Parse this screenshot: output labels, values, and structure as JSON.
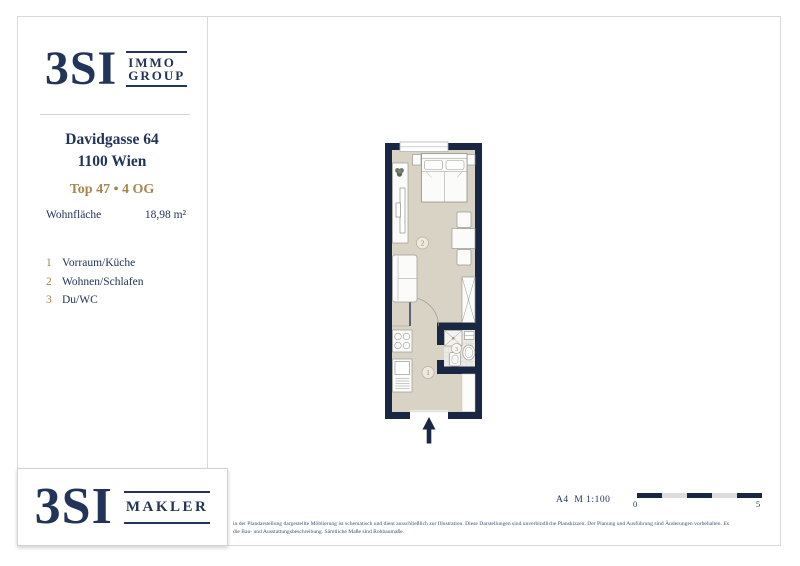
{
  "brand_top": {
    "name": "3SI",
    "line1": "IMMO",
    "line2": "GROUP"
  },
  "listing": {
    "address_line1": "Davidgasse 64",
    "address_line2": "1100 Wien",
    "unit_line": "Top 47 • 4 OG",
    "area_label": "Wohnfläche",
    "area_value": "18,98 m²"
  },
  "legend": {
    "items": [
      {
        "num": "1",
        "label": "Vorraum/Küche"
      },
      {
        "num": "2",
        "label": "Wohnen/Schlafen"
      },
      {
        "num": "3",
        "label": "Du/WC"
      }
    ]
  },
  "plan": {
    "room1_num": "1",
    "room2_num": "2",
    "room3_num": "3"
  },
  "brand_bottom": {
    "name": "3SI",
    "line1": "MAKLER"
  },
  "footer": {
    "scale_text": "A4  M 1:100",
    "scale_zero": "0",
    "scale_five": "5",
    "disclaimer_line1": "in der Plandarstellung dargestellte Möblierung ist schematisch und dient ausschließlich zur Illustration. Diese Darstellungen sind unverbindliche Planskizzen. Der Planung und Ausführung sind Änderungen vorbehalten. Es",
    "disclaimer_line2": "die Bau- und Ausstattungsbeschreibung. Sämtliche Maße sind Rohbaumaße."
  },
  "colors": {
    "navy_text": "#233459",
    "wall_navy": "#1a2742",
    "gold": "#a8854f",
    "floor_beige": "#d9d3c6"
  }
}
